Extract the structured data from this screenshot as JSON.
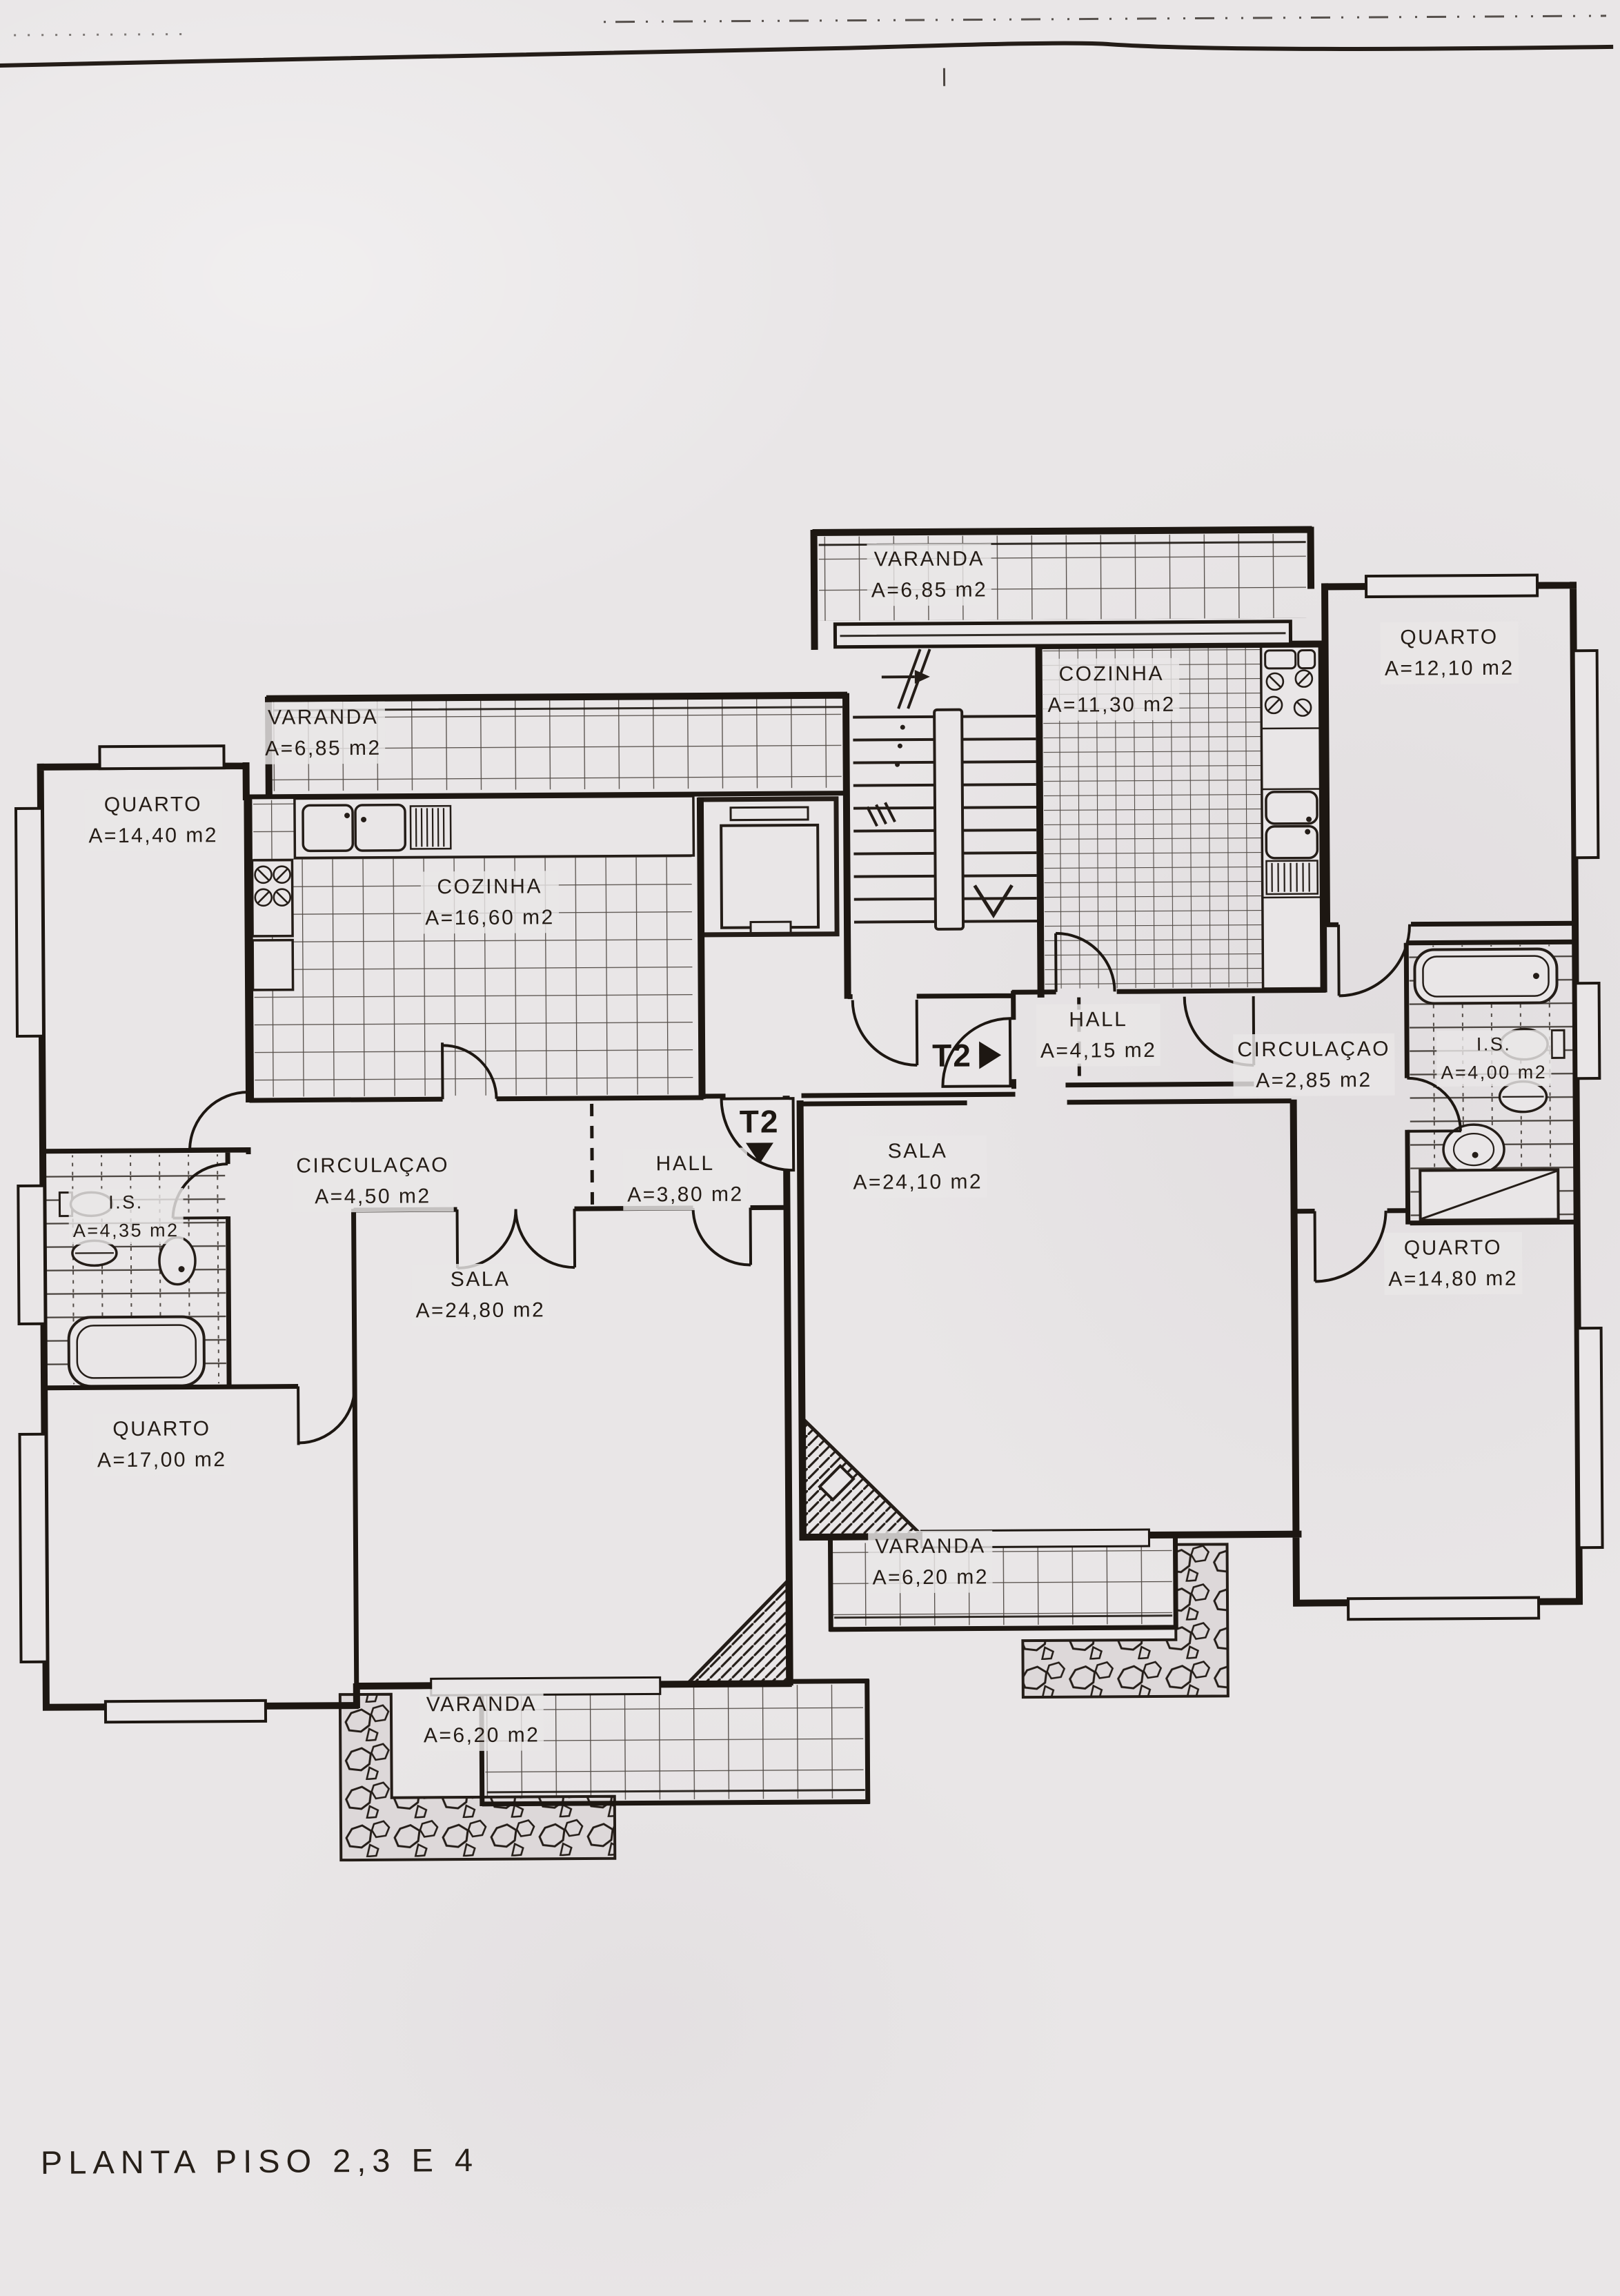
{
  "title": "PLANTA PISO 2,3 E 4",
  "unit_markers": {
    "t2_right": "T2",
    "t2_down": "T2"
  },
  "rooms": [
    {
      "id": "varanda-top",
      "name": "VARANDA",
      "area": "A=6,85 m2"
    },
    {
      "id": "cozinha-right",
      "name": "COZINHA",
      "area": "A=11,30 m2"
    },
    {
      "id": "quarto-ne",
      "name": "QUARTO",
      "area": "A=12,10 m2"
    },
    {
      "id": "varanda-left",
      "name": "VARANDA",
      "area": "A=6,85 m2"
    },
    {
      "id": "quarto-nw",
      "name": "QUARTO",
      "area": "A=14,40 m2"
    },
    {
      "id": "cozinha-left",
      "name": "COZINHA",
      "area": "A=16,60 m2"
    },
    {
      "id": "hall-right",
      "name": "HALL",
      "area": "A=4,15 m2"
    },
    {
      "id": "circulacao-right",
      "name": "CIRCULAÇAO",
      "area": "A=2,85 m2"
    },
    {
      "id": "is-right",
      "name": "I.S.",
      "area": "A=4,00 m2"
    },
    {
      "id": "sala-right",
      "name": "SALA",
      "area": "A=24,10 m2"
    },
    {
      "id": "circulacao-left",
      "name": "CIRCULAÇAO",
      "area": "A=4,50 m2"
    },
    {
      "id": "hall-left",
      "name": "HALL",
      "area": "A=3,80 m2"
    },
    {
      "id": "is-left",
      "name": "I.S.",
      "area": "A=4,35 m2"
    },
    {
      "id": "quarto-e",
      "name": "QUARTO",
      "area": "A=14,80 m2"
    },
    {
      "id": "sala-left",
      "name": "SALA",
      "area": "A=24,80 m2"
    },
    {
      "id": "quarto-sw",
      "name": "QUARTO",
      "area": "A=17,00 m2"
    },
    {
      "id": "varanda-bottom-right",
      "name": "VARANDA",
      "area": "A=6,20 m2"
    },
    {
      "id": "varanda-bottom-left",
      "name": "VARANDA",
      "area": "A=6,20 m2"
    }
  ]
}
